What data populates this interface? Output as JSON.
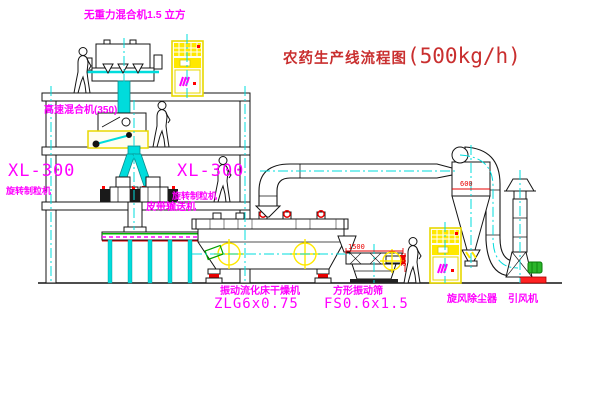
{
  "title": {
    "prefix": "农药生产线流程图",
    "capacity": "(500kg/h)"
  },
  "labels": {
    "gravity_mixer": "无重力混合机1.5 立方",
    "high_speed_mixer": "高速混合机(350)",
    "granulator_model_left": "XL-300",
    "granulator_name_left": "旋转制粒机",
    "granulator_model_right": "XL-300",
    "granulator_name_right": "旋转制粒机",
    "belt_conveyor": "皮带输送机",
    "fluid_bed_dryer": "振动流化床干燥机",
    "fluid_bed_dryer_model": "ZLG6x0.75",
    "square_sieve": "方形振动筛",
    "square_sieve_model": "FS0.6x1.5",
    "cyclone": "旋风除尘器",
    "fan": "引风机"
  },
  "dimensions": {
    "sieve_width": "1500",
    "sieve_height": "342",
    "cyclone_diameter": "600"
  },
  "colors": {
    "label_magenta": "#ff00ff",
    "title_red": "#c92f2f",
    "centerline_cyan": "#00dcdc",
    "highlight_yellow": "#ffe800",
    "accent_red": "#ff0000",
    "motor_green": "#2ab52a"
  }
}
